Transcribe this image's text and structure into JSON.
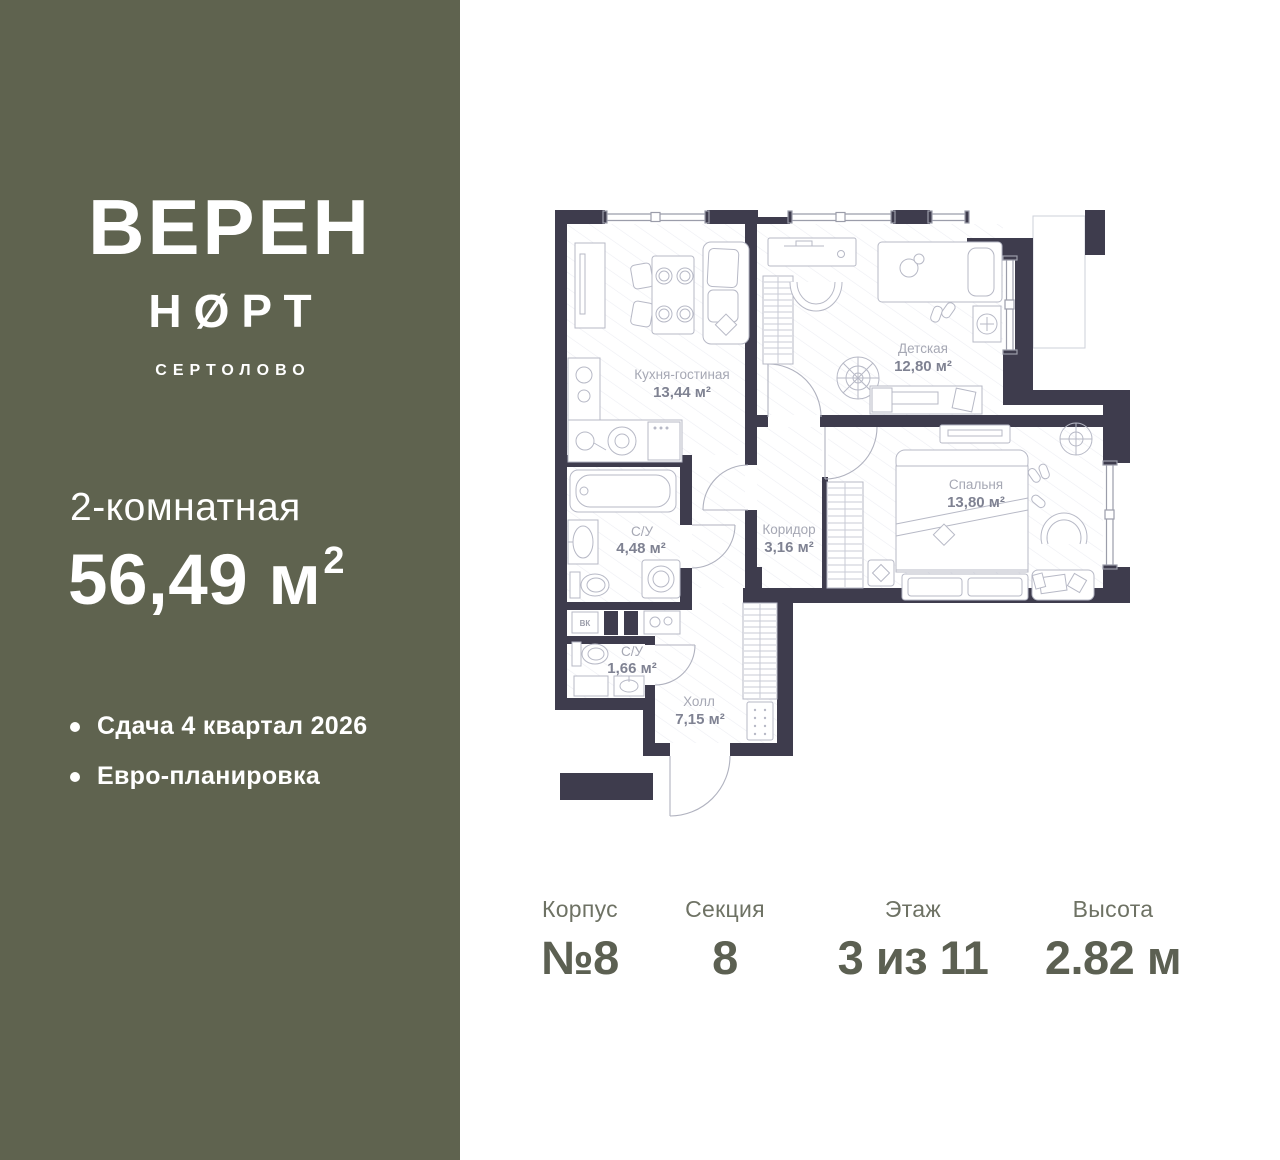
{
  "sidebar": {
    "logo_line1": "ВЕРЕН",
    "logo_line2": "НØРТ",
    "logo_sub": "СЕРТОЛОВО",
    "apartment_type": "2-комнатная",
    "area_value": "56,49 м",
    "area_sup": "2",
    "features": [
      "Сдача 4 квартал 2026",
      "Евро-планировка"
    ],
    "bg_color": "#5f634f"
  },
  "plan": {
    "wall_color": "#3e3c4d",
    "vk_label": "ВК",
    "rooms": [
      {
        "name": "Кухня-гостиная",
        "area": "13,44 м²"
      },
      {
        "name": "Детская",
        "area": "12,80 м²"
      },
      {
        "name": "Спальня",
        "area": "13,80 м²"
      },
      {
        "name": "С/У",
        "area": "4,48 м²"
      },
      {
        "name": "Коридор",
        "area": "3,16 м²"
      },
      {
        "name": "С/У",
        "area": "1,66 м²"
      },
      {
        "name": "Холл",
        "area": "7,15 м²"
      }
    ]
  },
  "details": {
    "columns": [
      {
        "label": "Корпус",
        "value": "№8"
      },
      {
        "label": "Секция",
        "value": "8"
      },
      {
        "label": "Этаж",
        "value": "3 из 11"
      },
      {
        "label": "Высота",
        "value": "2.82 м"
      }
    ]
  }
}
